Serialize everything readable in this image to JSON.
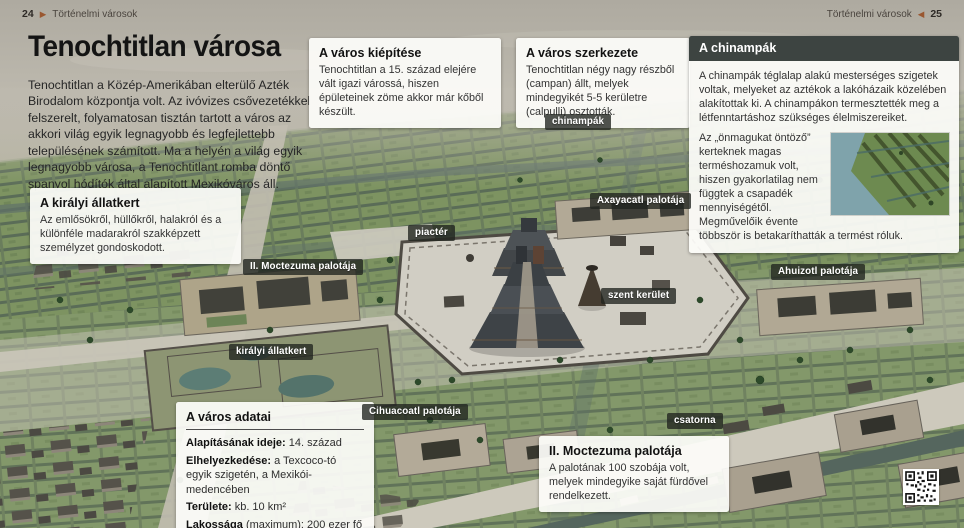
{
  "header": {
    "left_page": "24",
    "left_arrow": "▶",
    "left_title": "Történelmi városok",
    "right_title": "Történelmi városok",
    "right_arrow": "◀",
    "right_page": "25"
  },
  "intro": {
    "title": "Tenochtitlan városa",
    "body": "Tenochtitlan a Közép-Amerikában elterülő Azték Birodalom központja volt. Az ivóvizes csővezetékkel felszerelt, folyamatosan tisztán tartott a város az akkori világ egyik legnagyobb és legfejlettebb településének számított. Ma a helyén a világ egyik legnagyobb városa, a Tenochtitlant romba döntő spanyol hódítók által alapított Mexikóváros áll."
  },
  "boxes": {
    "kiepitese": {
      "title": "A város kiépítése",
      "body": "Tenochtitlan a 15. század elejére vált igazi várossá, hiszen épületeinek zöme akkor már kőből készült."
    },
    "szerkezete": {
      "title": "A város szerkezete",
      "body": "Tenochtitlan négy nagy részből (campan) állt, melyek mindegyikét 5-5 kerületre (calpulli) osztották."
    },
    "chinampak": {
      "title": "A chinampák",
      "body1": "A chinampák téglalap alakú mesterséges szigetek voltak, melyeket az aztékok a lakóházaik közelében alakítottak ki. A chinampákon termesztették meg a létfenntartáshoz szükséges élelmiszereiket.",
      "body2": "Az „önmagukat öntöző” kerteknek magas terméshozamuk volt, hiszen gyakorlatilag nem függtek a csapadék mennyiségétől. Megművelőik évente többször is betakaríthatták a termést róluk.",
      "inset_image": "chinampa-aerial-photo"
    },
    "allatkert": {
      "title": "A királyi állatkert",
      "body": "Az emlősökről, hüllőkről, halakról és a különféle madarakról szakképzett személyzet gondoskodott."
    },
    "adatai": {
      "title": "A város adatai",
      "rows": [
        {
          "label": "Alapításának ideje:",
          "value": "14. század"
        },
        {
          "label": "Elhelyezkedése:",
          "value": "a Texcoco-tó egyik szigetén, a Mexikói-medencében"
        },
        {
          "label": "Területe:",
          "value": "kb. 10 km²"
        },
        {
          "label": "Lakossága",
          "value": "(maximum): 200 ezer fő"
        }
      ]
    },
    "moctezuma": {
      "title": "II. Moctezuma palotája",
      "body": "A palotának 100 szobája volt, melyek mindegyike saját fürdővel rendelkezett."
    }
  },
  "map_labels": [
    {
      "text": "chinampák"
    },
    {
      "text": "Axayacatl palotája"
    },
    {
      "text": "piactér"
    },
    {
      "text": "II. Moctezuma palotája"
    },
    {
      "text": "Ahuizotl palotája"
    },
    {
      "text": "szent kerület"
    },
    {
      "text": "királyi állatkert"
    },
    {
      "text": "Cihuacoatl palotája"
    },
    {
      "text": "csatorna"
    }
  ],
  "icons": {
    "qr": "qr-code",
    "pager_arrows": "triangle-arrows"
  },
  "colors": {
    "accent_arrow": "#9a5730",
    "map_label_bg": "rgba(32,36,31,0.78)",
    "dark_box_header": "#3d4441",
    "plaza": "#d1cec4",
    "field_green": "#7d9361",
    "lake_gray": "#b5b1a7"
  }
}
